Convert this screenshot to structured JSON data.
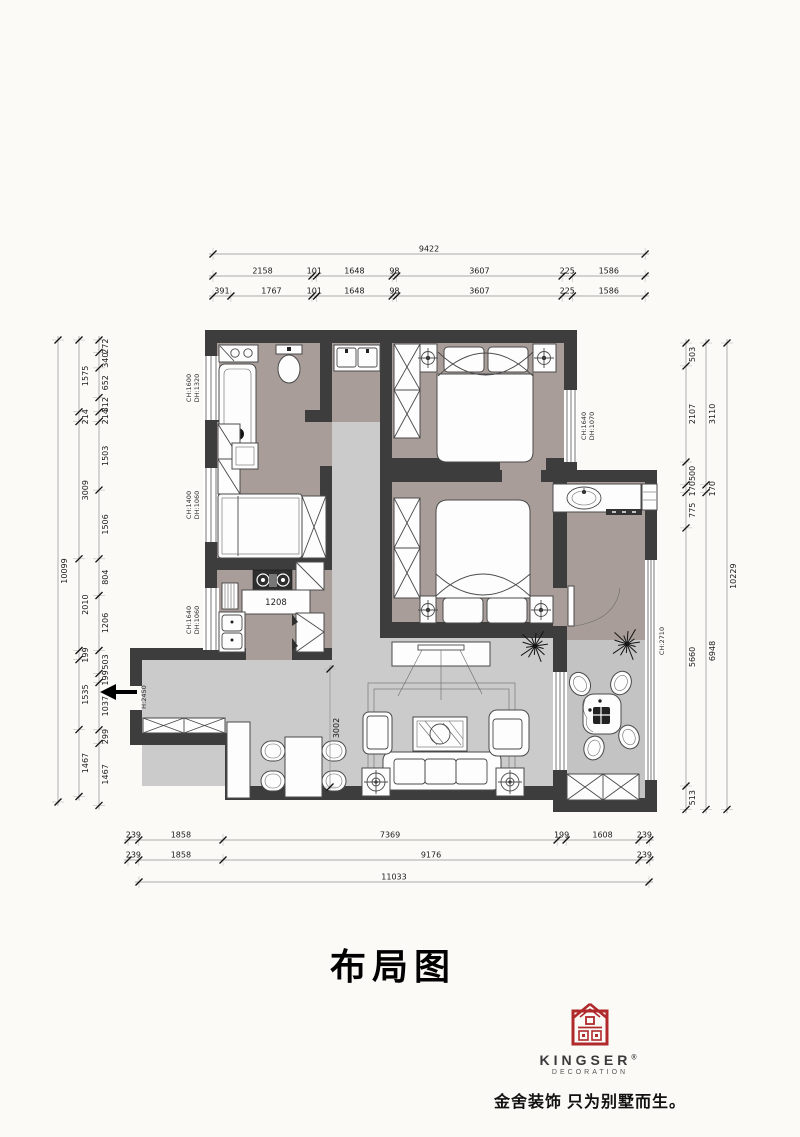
{
  "title": "布局图",
  "dims": {
    "top": {
      "total": [
        "9422"
      ],
      "row1": [
        "2158",
        "101",
        "1648",
        "98",
        "3607",
        "225",
        "1586"
      ],
      "row2": [
        "391",
        "1767",
        "101",
        "1648",
        "98",
        "3607",
        "225",
        "1586"
      ]
    },
    "bottom": {
      "row1": [
        "239",
        "1858",
        "7369",
        "199",
        "1608",
        "239"
      ],
      "row2": [
        "239",
        "1858",
        "9176",
        "239"
      ],
      "total": [
        "11033"
      ]
    },
    "left": {
      "outer": [
        "10099"
      ],
      "mid": [
        "1575",
        "214",
        "3009",
        "2010",
        "199",
        "1535",
        "1467"
      ],
      "inner": [
        "272",
        "340",
        "652",
        "312",
        "214",
        "1503",
        "1506",
        "804",
        "1206",
        "503",
        "199",
        "1037",
        "299",
        "1467"
      ]
    },
    "right": {
      "inner": [
        "503",
        "2107",
        "500",
        "170",
        "775",
        "5660",
        "513"
      ],
      "mid": [
        "3110",
        "170",
        "6948"
      ],
      "outer": [
        "10229"
      ]
    },
    "interior": {
      "dining": [
        "3002"
      ]
    }
  },
  "plan": {
    "labels": {
      "bath_ch": "CH:1600",
      "bath_dh": "DH:1320",
      "study_ch": "CH:1400",
      "study_dh": "DH:1060",
      "kitchen_ch": "CH:1640",
      "kitchen_dh": "DH:1060",
      "bed1_dh": "DH:1070",
      "bed1_ch": "CH:1640",
      "balcony_ch": "CH:2710",
      "entry_h": "H:2450",
      "island": "1208"
    }
  },
  "logo": {
    "brand": "KINGSER",
    "reg": "®",
    "sub": "DECORATION",
    "tagline": "金舍装饰 只为别墅而生。"
  }
}
